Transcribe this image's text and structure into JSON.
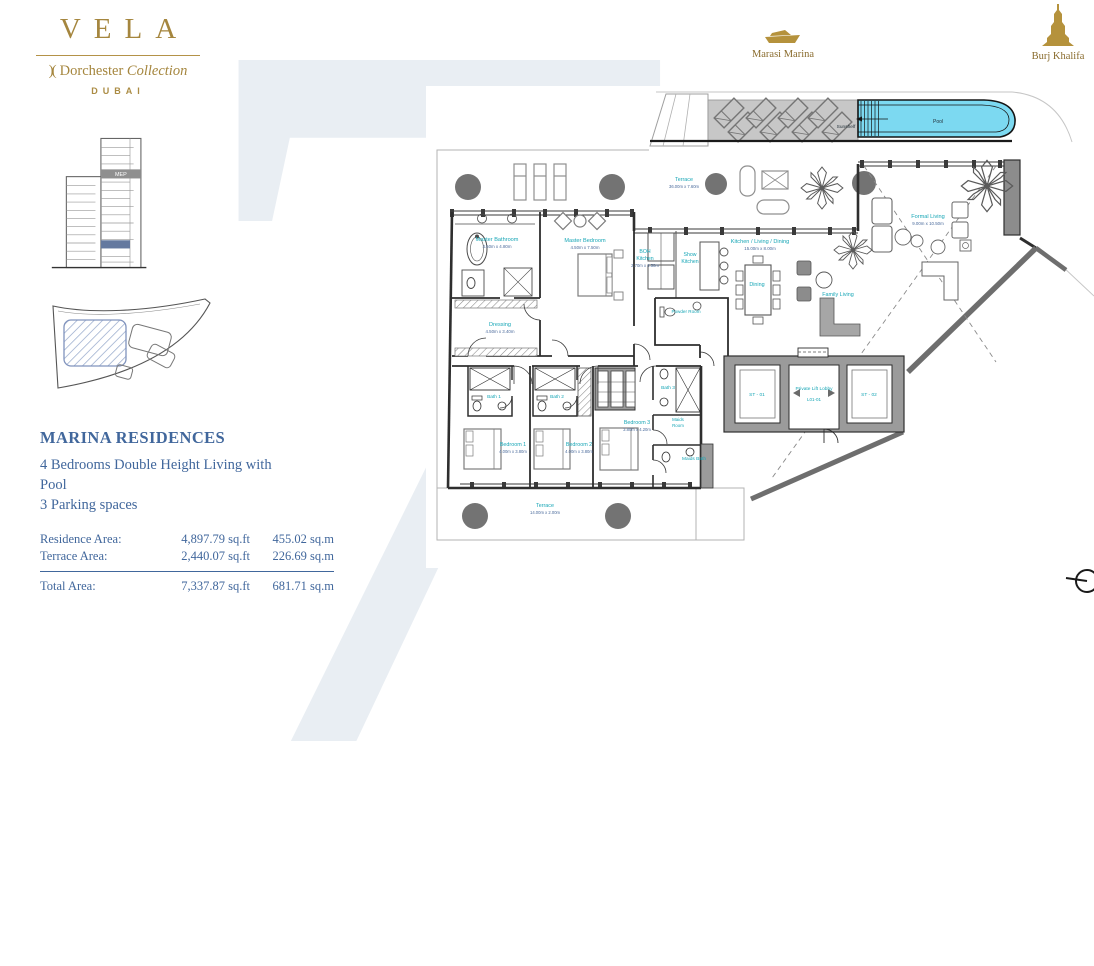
{
  "brand": {
    "logo": "VELA",
    "mark": ")(",
    "collection": "Dorchester",
    "collection_italic": "Collection",
    "city": "DUBAI",
    "mep": "MEP"
  },
  "landmarks": {
    "marina": "Marasi Marina",
    "burj": "Burj Khalifa"
  },
  "watermark": "7",
  "unit": {
    "title": "MARINA RESIDENCES",
    "subtitle1": "4 Bedrooms Double Height Living with Pool",
    "subtitle2": "3 Parking spaces",
    "areas": [
      {
        "label": "Residence Area:",
        "sqft": "4,897.79 sq.ft",
        "sqm": "455.02 sq.m"
      },
      {
        "label": "Terrace Area:",
        "sqft": "2,440.07 sq.ft",
        "sqm": "226.69 sq.m"
      }
    ],
    "total": {
      "label": "Total Area:",
      "sqft": "7,337.87 sq.ft",
      "sqm": "681.71 sq.m"
    }
  },
  "plan": {
    "rooms": [
      {
        "name": "Master Bathroom",
        "dims": "4.50m x 4.80m"
      },
      {
        "name": "Master Bedroom",
        "dims": "4.50m x 7.50m"
      },
      {
        "name": "Dressing",
        "dims": "4.50m x 3.40m"
      },
      {
        "name": "BOH",
        "name2": "Kitchen",
        "dims": "2.70m x 4.50m"
      },
      {
        "name": "Show",
        "name2": "Kitchen"
      },
      {
        "name": "Kitchen / Living / Dining",
        "dims": "15.00m x 8.00m"
      },
      {
        "name": "Dining"
      },
      {
        "name": "Family Living"
      },
      {
        "name": "Formal Living",
        "dims": "9.00m x 10.50m"
      },
      {
        "name": "Powder Room"
      },
      {
        "name": "Private Lift Lobby",
        "code": "L01-01"
      },
      {
        "name": "ST - 01"
      },
      {
        "name": "ST - 02"
      },
      {
        "name": "Bath 1"
      },
      {
        "name": "Bath 2"
      },
      {
        "name": "Bath 3"
      },
      {
        "name": "Maids",
        "name2": "Room"
      },
      {
        "name": "Maids Bath"
      },
      {
        "name": "Bedroom 1",
        "dims": "4.00m x 3.80m"
      },
      {
        "name": "Bedroom 2",
        "dims": "4.00m x 3.80m"
      },
      {
        "name": "Bedroom 3",
        "dims": "3.80m x 4.20m"
      },
      {
        "name": "Terrace",
        "dims": "36.00m x 7.60m"
      },
      {
        "name": "Terrace",
        "dims": "14.00m x 2.00m"
      },
      {
        "name": "Sunshelf"
      },
      {
        "name": "Pool"
      }
    ],
    "colors": {
      "accent_gold": "#a5863e",
      "text_blue": "#41679c",
      "room_label_teal": "#17a6b6",
      "dims_blue": "#4a6a9b",
      "pool_fill": "#7cd9f1",
      "deck_gray": "#c7c7c7",
      "watermark": "#e9eef3"
    }
  }
}
